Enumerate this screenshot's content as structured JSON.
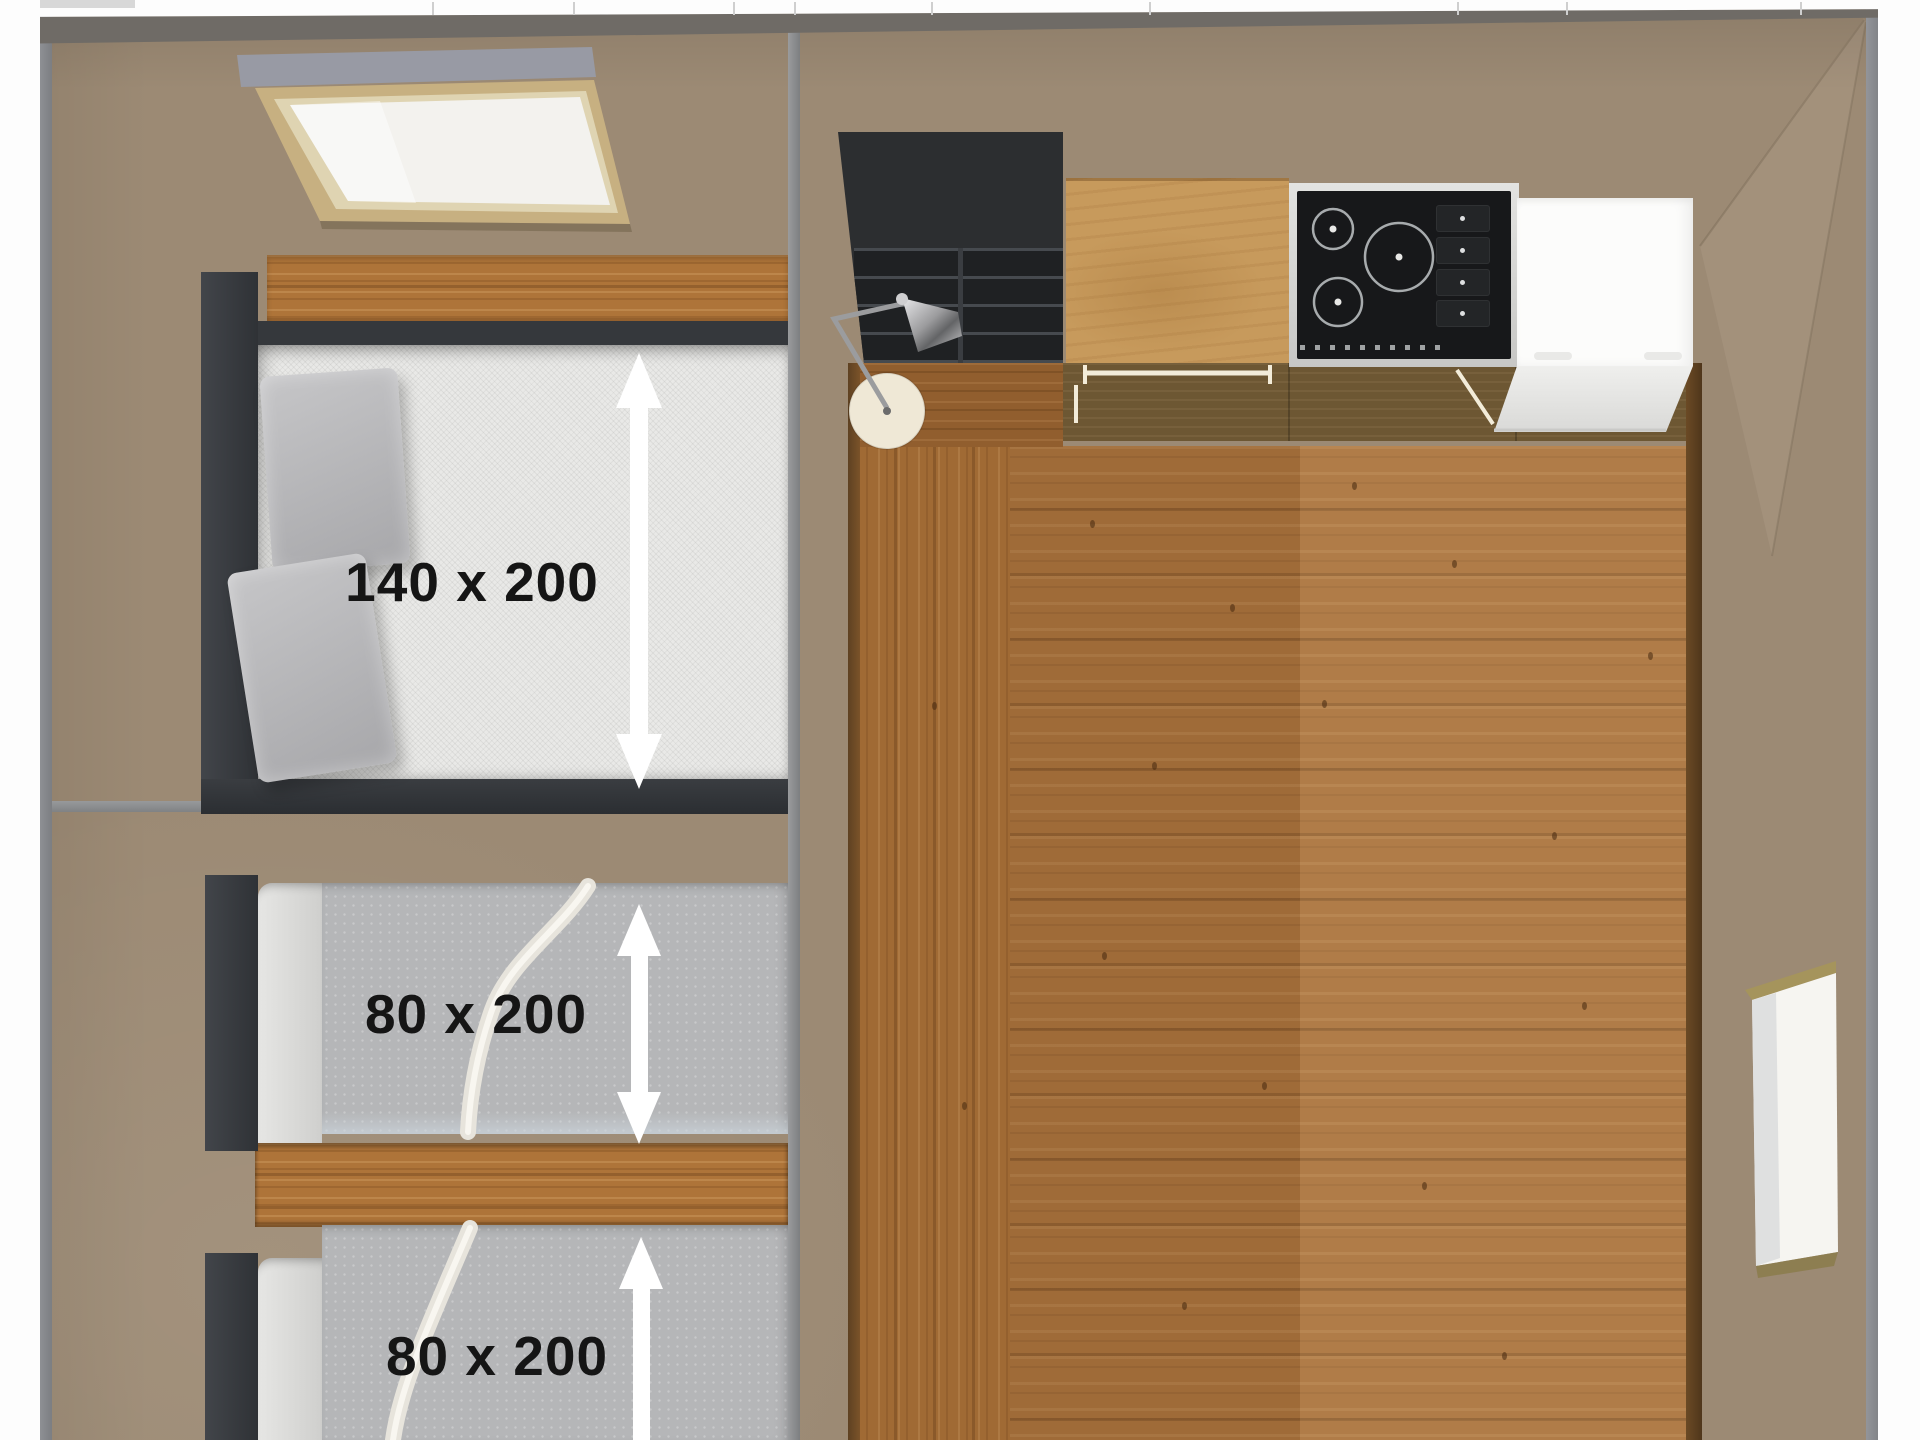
{
  "plan": {
    "type": "3d-floor-plan-top-view",
    "dimension_labels": {
      "double_bed": "140 x 200",
      "single_bed_top": "80 x 200",
      "single_bed_bottom": "80 x 200"
    },
    "colors": {
      "wall_taupe": "#9C8A74",
      "wall_outline": "#85878A",
      "page_white": "#FDFDFD",
      "bed_frame": "#35383C",
      "mattress": "#E9E9E7",
      "pillow": "#B4B4B6",
      "blanket": "#B5B6B8",
      "wood_accent": "#AE7439",
      "floor_wood": "#A8713B",
      "shelf_black": "#2C2E30",
      "counter_oak": "#C79A5C",
      "cooktop_glass": "#17181A",
      "cooktop_frame": "#D8D8D6",
      "appliance_white": "#FCFCFB",
      "lamp_base": "#EFE8D6",
      "dimension_arrow": "#FFFFFF"
    }
  }
}
